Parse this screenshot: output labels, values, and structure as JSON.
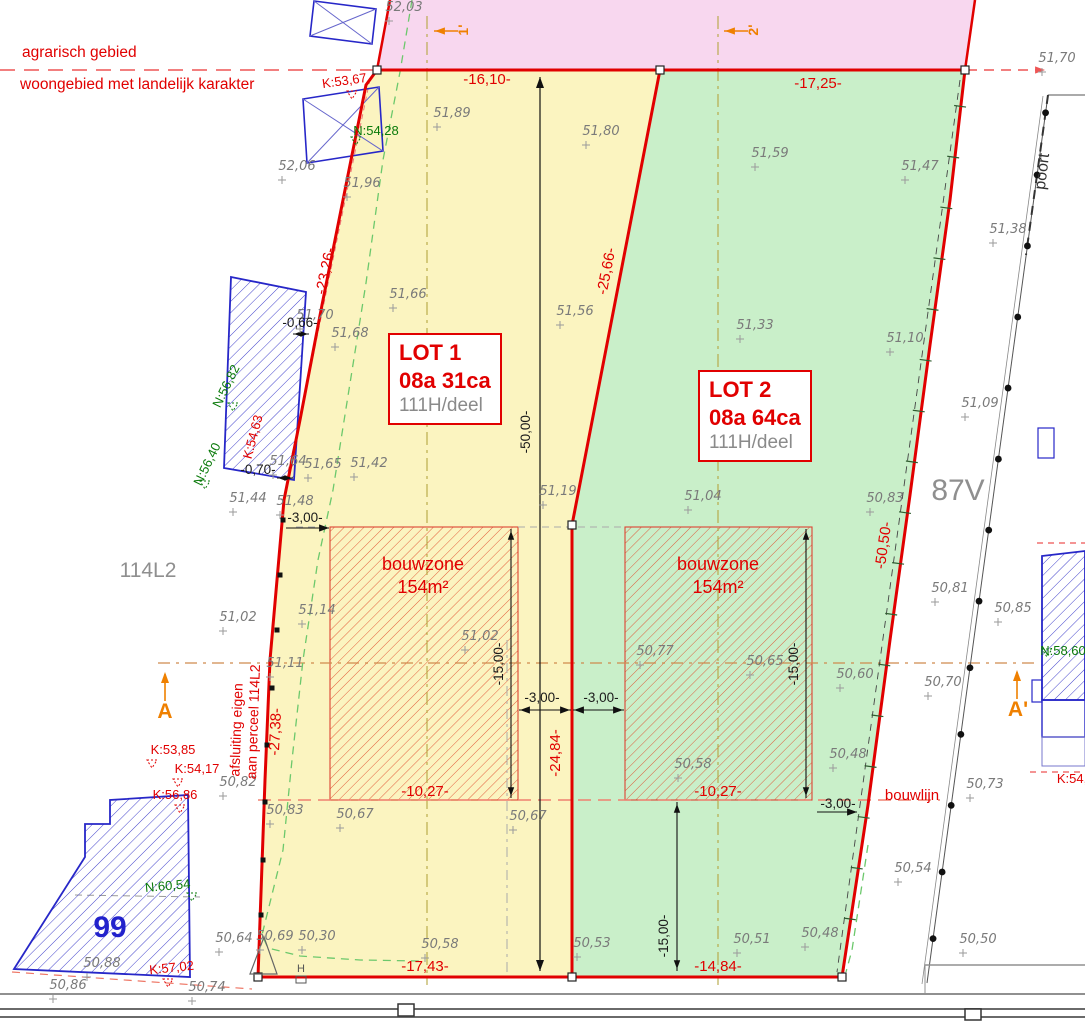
{
  "plan": {
    "zone_labels": {
      "top": "agrarisch gebied",
      "bottom": "woongebied met landelijk karakter"
    },
    "lots": [
      {
        "name": "LOT 1",
        "area": "08a 31ca",
        "parcel": "111H/deel"
      },
      {
        "name": "LOT 2",
        "area": "08a 64ca",
        "parcel": "111H/deel"
      }
    ],
    "bouwzones": [
      {
        "label": "bouwzone",
        "area": "154m²",
        "x": 423,
        "y": 570
      },
      {
        "label": "bouwzone",
        "area": "154m²",
        "x": 718,
        "y": 570
      }
    ],
    "parcel_labels": [
      {
        "text": "114L2",
        "x": 148,
        "y": 577,
        "color": "#8f8f8f",
        "size": 21,
        "bold": false
      },
      {
        "text": "87V",
        "x": 958,
        "y": 500,
        "color": "#8f8f8f",
        "size": 30,
        "bold": false
      },
      {
        "text": "99",
        "x": 110,
        "y": 937,
        "color": "#2222cc",
        "size": 30,
        "bold": true
      }
    ],
    "section_markers": [
      {
        "label": "A",
        "x": 165,
        "y": 718,
        "rot": 0,
        "size": 21
      },
      {
        "label": "A'",
        "x": 1018,
        "y": 716,
        "rot": 0,
        "size": 21
      },
      {
        "label": "1'",
        "x": 468,
        "y": 30,
        "rot": -90,
        "size": 14
      },
      {
        "label": "2'",
        "x": 758,
        "y": 30,
        "rot": -90,
        "size": 14
      }
    ],
    "dimensions": [
      {
        "text": "-16,10-",
        "x": 487,
        "y": 84,
        "rot": 0,
        "cls": "dimred"
      },
      {
        "text": "-17,25-",
        "x": 818,
        "y": 88,
        "rot": 0,
        "cls": "dimred"
      },
      {
        "text": "-23,26-",
        "x": 330,
        "y": 272,
        "rot": -78,
        "cls": "dimred"
      },
      {
        "text": "-25,66-",
        "x": 611,
        "y": 272,
        "rot": -79,
        "cls": "dimred"
      },
      {
        "text": "-27,38-",
        "x": 280,
        "y": 732,
        "rot": -87,
        "cls": "dimred"
      },
      {
        "text": "-50,50-",
        "x": 888,
        "y": 546,
        "rot": -82,
        "cls": "dimred"
      },
      {
        "text": "-24,84-",
        "x": 560,
        "y": 753,
        "rot": -90,
        "cls": "dimred"
      },
      {
        "text": "-10,27-",
        "x": 425,
        "y": 796,
        "rot": 0,
        "cls": "dimred"
      },
      {
        "text": "-10,27-",
        "x": 718,
        "y": 796,
        "rot": 0,
        "cls": "dimred"
      },
      {
        "text": "-17,43-",
        "x": 425,
        "y": 971,
        "rot": 0,
        "cls": "dimred"
      },
      {
        "text": "-14,84-",
        "x": 718,
        "y": 971,
        "rot": 0,
        "cls": "dimred"
      },
      {
        "text": "-50,00-",
        "x": 530,
        "y": 432,
        "rot": -90,
        "cls": "dimblk"
      },
      {
        "text": "-15,00-",
        "x": 503,
        "y": 664,
        "rot": -90,
        "cls": "dimblk"
      },
      {
        "text": "-15,00-",
        "x": 798,
        "y": 664,
        "rot": -90,
        "cls": "dimblk"
      },
      {
        "text": "-15,00-",
        "x": 668,
        "y": 936,
        "rot": -90,
        "cls": "dimblk"
      },
      {
        "text": "-3,00-",
        "x": 305,
        "y": 522,
        "rot": 0,
        "cls": "dimblk"
      },
      {
        "text": "-3,00-",
        "x": 542,
        "y": 702,
        "rot": 0,
        "cls": "dimblk"
      },
      {
        "text": "-3,00-",
        "x": 601,
        "y": 702,
        "rot": 0,
        "cls": "dimblk"
      },
      {
        "text": "-3,00-",
        "x": 838,
        "y": 808,
        "rot": 0,
        "cls": "dimblk"
      },
      {
        "text": "-0,66-",
        "x": 300,
        "y": 327,
        "rot": 0,
        "cls": "dimblk"
      },
      {
        "text": "-0,70-",
        "x": 258,
        "y": 474,
        "rot": 0,
        "cls": "dimblk"
      }
    ],
    "k_points": [
      {
        "v": "K:53,67",
        "x": 345,
        "y": 85,
        "rot": -8
      },
      {
        "v": "K:54,63",
        "x": 257,
        "y": 438,
        "rot": -75
      },
      {
        "v": "K:53,85",
        "x": 173,
        "y": 754,
        "rot": 0
      },
      {
        "v": "K:54,17",
        "x": 197,
        "y": 773,
        "rot": 0
      },
      {
        "v": "K:56,86",
        "x": 175,
        "y": 799,
        "rot": 0
      },
      {
        "v": "K:57,02",
        "x": 172,
        "y": 972,
        "rot": -6
      },
      {
        "v": "K:54,",
        "x": 1072,
        "y": 783,
        "rot": 0
      }
    ],
    "n_points": [
      {
        "v": "N:54,28",
        "x": 376,
        "y": 135,
        "rot": 0
      },
      {
        "v": "N:56,82",
        "x": 230,
        "y": 388,
        "rot": -64
      },
      {
        "v": "N:56,40",
        "x": 211,
        "y": 466,
        "rot": -64
      },
      {
        "v": "N:60,54",
        "x": 168,
        "y": 890,
        "rot": -5
      },
      {
        "v": "N:58,60",
        "x": 1063,
        "y": 655,
        "rot": 0
      }
    ],
    "triangle_marks": [
      {
        "x": 352,
        "y": 96,
        "c": "#e10000"
      },
      {
        "x": 152,
        "y": 765,
        "c": "#e10000"
      },
      {
        "x": 178,
        "y": 784,
        "c": "#e10000"
      },
      {
        "x": 180,
        "y": 810,
        "c": "#e10000"
      },
      {
        "x": 168,
        "y": 984,
        "c": "#e10000"
      },
      {
        "x": 192,
        "y": 898,
        "c": "#0a7a0a"
      },
      {
        "x": 1047,
        "y": 654,
        "c": "#0a7a0a"
      },
      {
        "x": 356,
        "y": 142,
        "c": "#0a7a0a"
      },
      {
        "x": 233,
        "y": 408,
        "c": "#0a7a0a"
      },
      {
        "x": 205,
        "y": 486,
        "c": "#0a7a0a"
      }
    ],
    "elevations": [
      {
        "v": "52,03",
        "x": 404,
        "y": 7
      },
      {
        "v": "51,89",
        "x": 452,
        "y": 113
      },
      {
        "v": "51,80",
        "x": 601,
        "y": 131
      },
      {
        "v": "52,06",
        "x": 297,
        "y": 166
      },
      {
        "v": "51,96",
        "x": 362,
        "y": 183
      },
      {
        "v": "51,59",
        "x": 770,
        "y": 153
      },
      {
        "v": "51,47",
        "x": 920,
        "y": 166
      },
      {
        "v": "51,70",
        "x": 1057,
        "y": 58
      },
      {
        "v": "51,38",
        "x": 1008,
        "y": 229
      },
      {
        "v": "51,66",
        "x": 408,
        "y": 294
      },
      {
        "v": "51,56",
        "x": 575,
        "y": 311
      },
      {
        "v": "51,70",
        "x": 315,
        "y": 315
      },
      {
        "v": "51,68",
        "x": 350,
        "y": 333
      },
      {
        "v": "51,33",
        "x": 755,
        "y": 325
      },
      {
        "v": "51,10",
        "x": 905,
        "y": 338
      },
      {
        "v": "51,09",
        "x": 980,
        "y": 403
      },
      {
        "v": "51,64",
        "x": 288,
        "y": 461
      },
      {
        "v": "51,65",
        "x": 323,
        "y": 464
      },
      {
        "v": "51,42",
        "x": 369,
        "y": 463
      },
      {
        "v": "51,44",
        "x": 248,
        "y": 498
      },
      {
        "v": "51,48",
        "x": 295,
        "y": 501
      },
      {
        "v": "51,19",
        "x": 558,
        "y": 491
      },
      {
        "v": "51,04",
        "x": 703,
        "y": 496
      },
      {
        "v": "50,83",
        "x": 885,
        "y": 498
      },
      {
        "v": "51,14",
        "x": 317,
        "y": 610
      },
      {
        "v": "51,02",
        "x": 238,
        "y": 617
      },
      {
        "v": "51,02",
        "x": 480,
        "y": 636
      },
      {
        "v": "51,11",
        "x": 285,
        "y": 663
      },
      {
        "v": "50,77",
        "x": 655,
        "y": 651
      },
      {
        "v": "50,65",
        "x": 765,
        "y": 661
      },
      {
        "v": "50,60",
        "x": 855,
        "y": 674
      },
      {
        "v": "50,81",
        "x": 950,
        "y": 588
      },
      {
        "v": "50,85",
        "x": 1013,
        "y": 608
      },
      {
        "v": "50,70",
        "x": 943,
        "y": 682
      },
      {
        "v": "50,48",
        "x": 848,
        "y": 754
      },
      {
        "v": "50,58",
        "x": 693,
        "y": 764
      },
      {
        "v": "50,73",
        "x": 985,
        "y": 784
      },
      {
        "v": "50,82",
        "x": 238,
        "y": 782
      },
      {
        "v": "50,83",
        "x": 285,
        "y": 810
      },
      {
        "v": "50,67",
        "x": 355,
        "y": 814
      },
      {
        "v": "50,67",
        "x": 528,
        "y": 816
      },
      {
        "v": "50,54",
        "x": 913,
        "y": 868
      },
      {
        "v": "50,64",
        "x": 234,
        "y": 938
      },
      {
        "v": "50,69",
        "x": 275,
        "y": 936
      },
      {
        "v": "50,30",
        "x": 317,
        "y": 936
      },
      {
        "v": "50,58",
        "x": 440,
        "y": 944
      },
      {
        "v": "50,53",
        "x": 592,
        "y": 943
      },
      {
        "v": "50,51",
        "x": 752,
        "y": 939
      },
      {
        "v": "50,48",
        "x": 820,
        "y": 933
      },
      {
        "v": "50,50",
        "x": 978,
        "y": 939
      },
      {
        "v": "50,88",
        "x": 102,
        "y": 963
      },
      {
        "v": "50,86",
        "x": 68,
        "y": 985
      },
      {
        "v": "50,74",
        "x": 207,
        "y": 987
      }
    ],
    "other_labels": [
      {
        "t": "poort",
        "x": 1047,
        "y": 172,
        "rot": -83,
        "s": 16,
        "c": "#333333"
      },
      {
        "t": "bouwlijn",
        "x": 912,
        "y": 800,
        "rot": 0,
        "s": 15,
        "c": "#e10000"
      },
      {
        "t": "afsluiting eigen",
        "x": 241,
        "y": 730,
        "rot": -88,
        "s": 14,
        "c": "#e10000"
      },
      {
        "t": "aan perceel 114L2",
        "x": 258,
        "y": 722,
        "rot": -88,
        "s": 14,
        "c": "#e10000"
      },
      {
        "t": "H",
        "x": 301,
        "y": 972,
        "rot": 0,
        "s": 11,
        "c": "#555555"
      }
    ],
    "colors": {
      "agrarisch_fill": "#f8d7ef",
      "lot1_fill": "#fbf4c0",
      "lot2_fill": "#c9efc9",
      "boundary_red": "#e10000",
      "terrain_green": "#6cc86c",
      "orange": "#ef8000",
      "blue_buildings": "#2727c8"
    }
  }
}
